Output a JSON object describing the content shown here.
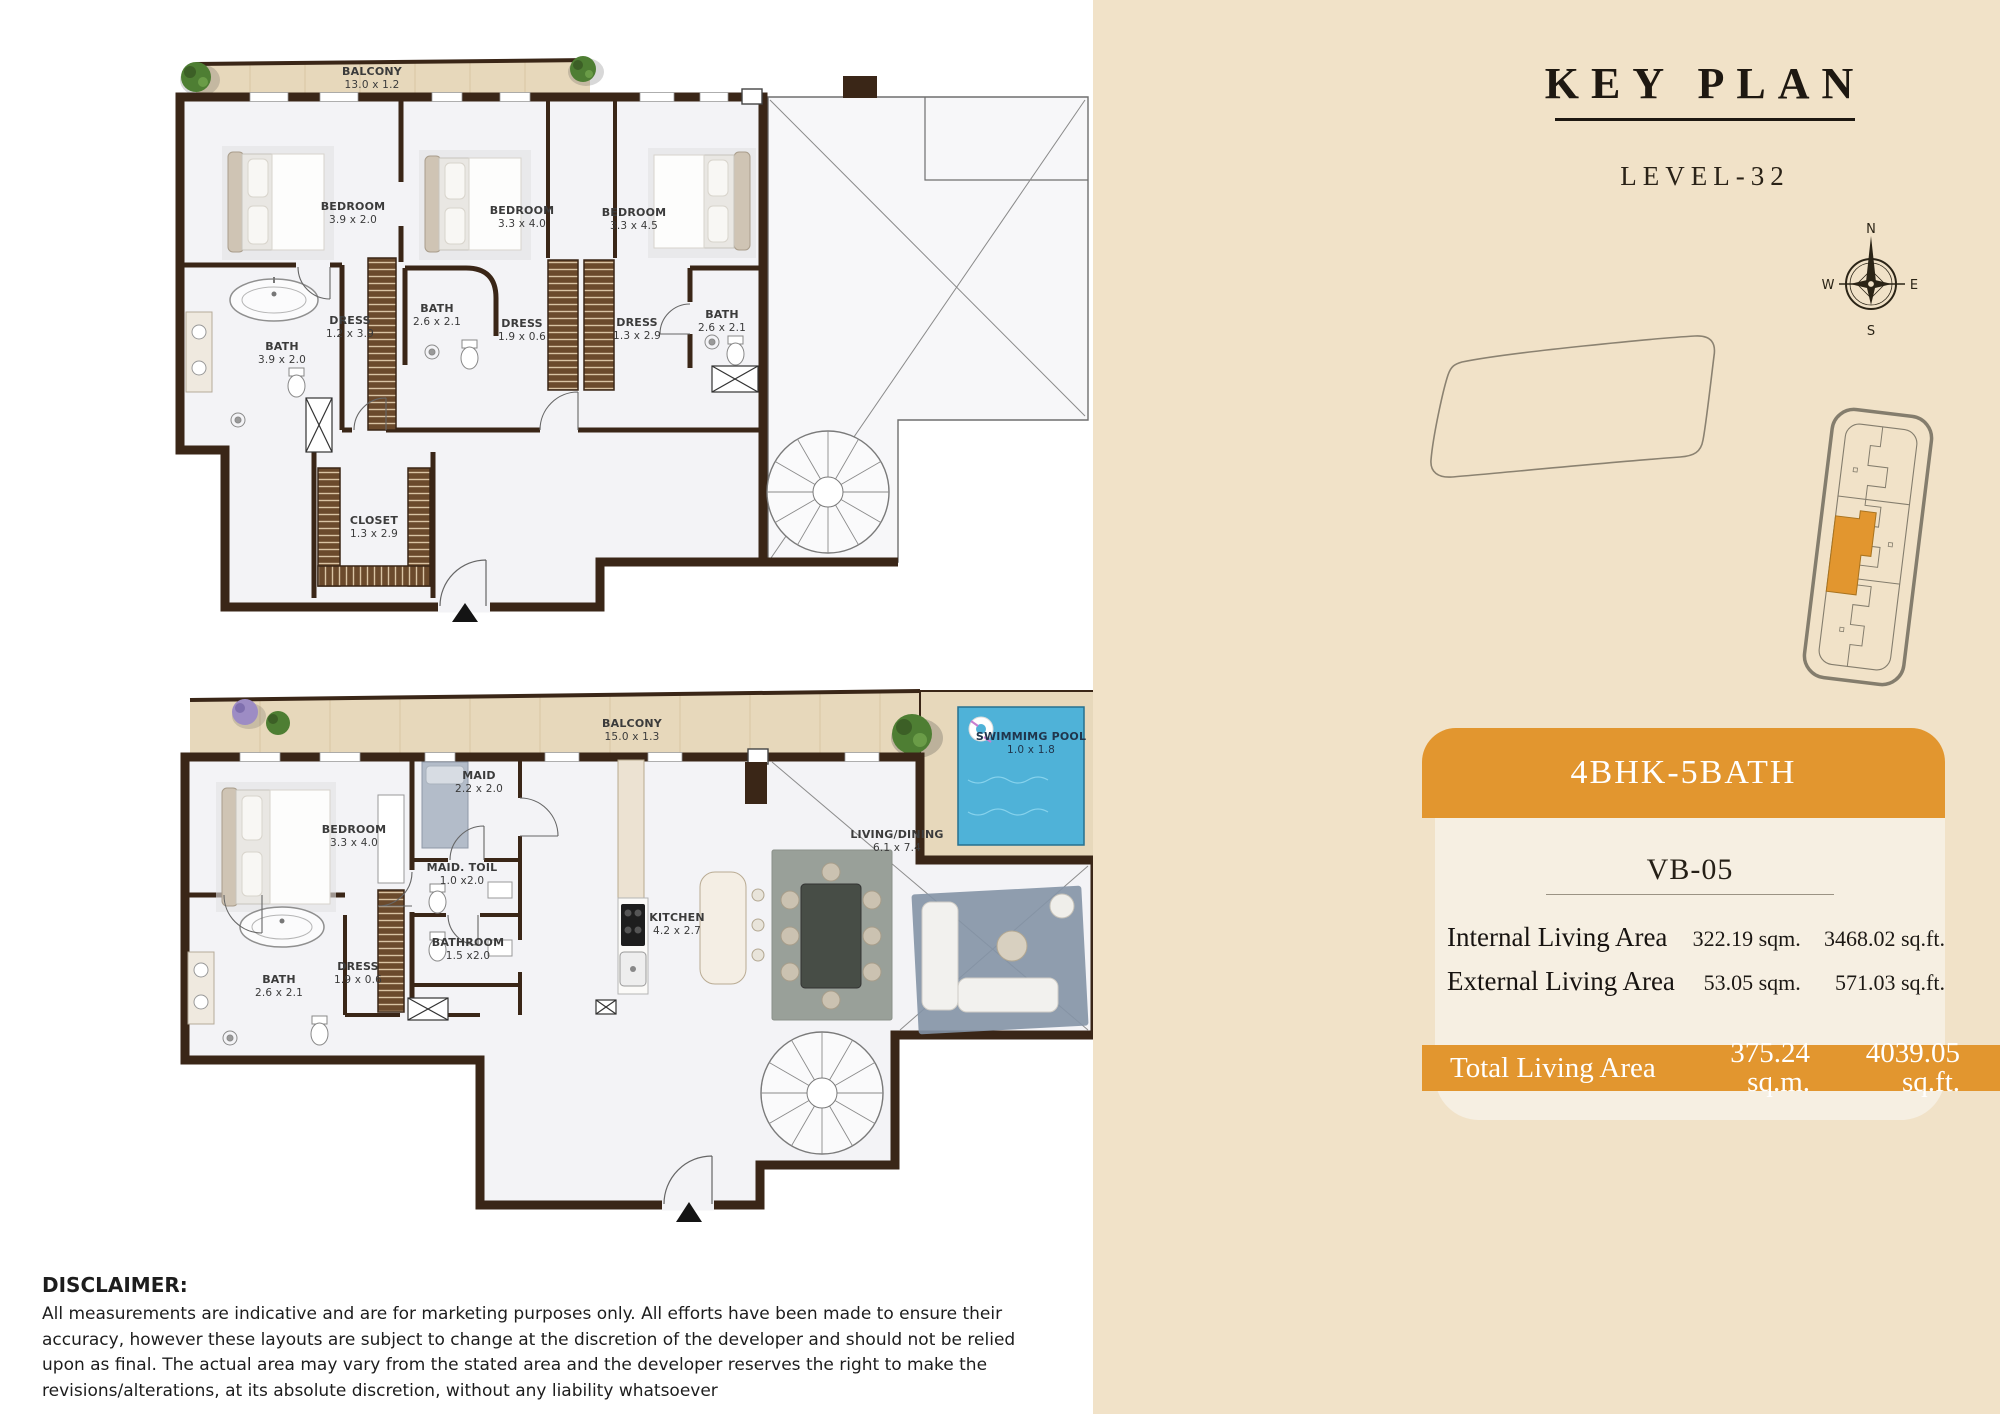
{
  "plans": {
    "upper": {
      "rooms": [
        {
          "name": "BALCONY",
          "dims": "13.0 x 1.2"
        },
        {
          "name": "BEDROOM",
          "dims": "3.9 x 2.0"
        },
        {
          "name": "BEDROOM",
          "dims": "3.3 x 4.0"
        },
        {
          "name": "BEDROOM",
          "dims": "3.3 x 4.5"
        },
        {
          "name": "BATH",
          "dims": "3.9 x 2.0"
        },
        {
          "name": "DRESS",
          "dims": "1.2 x 3.9"
        },
        {
          "name": "BATH",
          "dims": "2.6 x 2.1"
        },
        {
          "name": "DRESS",
          "dims": "1.9 x 0.6"
        },
        {
          "name": "DRESS",
          "dims": "1.3 x 2.9"
        },
        {
          "name": "BATH",
          "dims": "2.6 x 2.1"
        },
        {
          "name": "CLOSET",
          "dims": "1.3 x 2.9"
        }
      ]
    },
    "lower": {
      "rooms": [
        {
          "name": "BALCONY",
          "dims": "15.0 x 1.3"
        },
        {
          "name": "SWIMMIMG POOL",
          "dims": "1.0 x 1.8"
        },
        {
          "name": "BEDROOM",
          "dims": "3.3 x 4.0"
        },
        {
          "name": "MAID",
          "dims": "2.2 x 2.0"
        },
        {
          "name": "MAID. TOIL",
          "dims": "1.0 x2.0"
        },
        {
          "name": "BATHROOM",
          "dims": "1.5 x2.0"
        },
        {
          "name": "DRESS",
          "dims": "1.9 x 0.6"
        },
        {
          "name": "BATH",
          "dims": "2.6 x 2.1"
        },
        {
          "name": "KITCHEN",
          "dims": "4.2 x 2.7"
        },
        {
          "name": "LIVING/DINING",
          "dims": "6.1 x 7.4"
        }
      ]
    }
  },
  "sidebar": {
    "title": "KEY PLAN",
    "level": "LEVEL-32",
    "compass": {
      "north": "N",
      "east": "E",
      "south": "S",
      "west": "W"
    },
    "unit": {
      "type": "4BHK-5BATH",
      "code": "VB-05",
      "areas": [
        {
          "label": "Internal Living Area",
          "sqm": "322.19 sqm.",
          "sqft": "3468.02 sq.ft."
        },
        {
          "label": "External Living Area",
          "sqm": "53.05 sqm.",
          "sqft": "571.03 sq.ft."
        }
      ],
      "total": {
        "label": "Total Living Area",
        "sqm": "375.24 sq.m.",
        "sqft": "4039.05 sq.ft."
      }
    }
  },
  "disclaimer": {
    "heading": "DISCLAIMER:",
    "body": "All measurements are indicative and are for marketing purposes only. All efforts have been made to ensure their accuracy, however these layouts are subject to change at the discretion of the developer and should not be relied upon as final. The actual area may vary from the stated area and the developer reserves the right to make the revisions/alterations, at its absolute discretion, without any liability whatsoever"
  },
  "colors": {
    "accent": "#E2962F",
    "panel": "#F1E2C8",
    "card": "#F6EFE2",
    "wall": "#3A2617",
    "wood": "#E7D8BB",
    "pool": "#4FB2D8"
  }
}
